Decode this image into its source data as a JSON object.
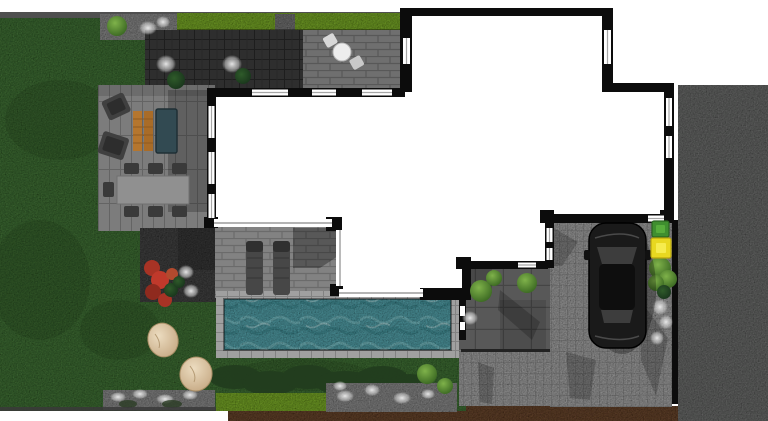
{
  "scene": {
    "kind": "landscape-garden-site-plan",
    "view": "top-down-render",
    "regions": [
      "lawn",
      "roof-terrace-house",
      "outdoor-dining-patio",
      "lounge-patio",
      "swimming-pool",
      "pool-deck",
      "courtyard",
      "driveway",
      "street",
      "sidewalk",
      "soil-border",
      "hedges",
      "gravel-beds",
      "boulders",
      "parked-car",
      "waste-bins"
    ]
  },
  "colors": {
    "page": "#ffffff",
    "lawn": "#45733a",
    "hedge": "#7cab2e",
    "darkHedge": "#223d1e",
    "water": "#57a3ab",
    "waterLight": "#8fd0d4",
    "waterDark": "#3c858e",
    "coping": "#a0a0a0",
    "road": "#6e6f6e",
    "driveway": "#a5a5a5",
    "sidewalk": "#9d9d9d",
    "patioBrick": "#6f6f6f",
    "deckBrick": "#828282",
    "planks": "#7c7c7c",
    "charcoal": "#2e2e2e",
    "slab": "#585858",
    "gravel": "#8c8c8c",
    "dirt": "#6a4a33",
    "wall": "#0c0c0c",
    "house": "#ffffff",
    "glassFrame": "#9c9c9c",
    "car": "#1a1a1a",
    "carGlass": "#3d3d3d",
    "binGreen": "#3f8f2f",
    "binYellow": "#e8d820",
    "boulderLight": "#ecdcc0",
    "boulderDark": "#c3a57f",
    "plantRed": "#a83325",
    "woodLounger": "#b5762e",
    "furnitureDark": "#3f3f3f",
    "daybed": "#324a52",
    "tableGray": "#909090",
    "bistroWhite": "#ededed",
    "tuftWhite": "#e4e4e4",
    "treeLight": "#7fb24a",
    "treeDark": "#35621f",
    "shrubDark": "#1d3a1e",
    "edgeLine": "#3a3a3a"
  }
}
